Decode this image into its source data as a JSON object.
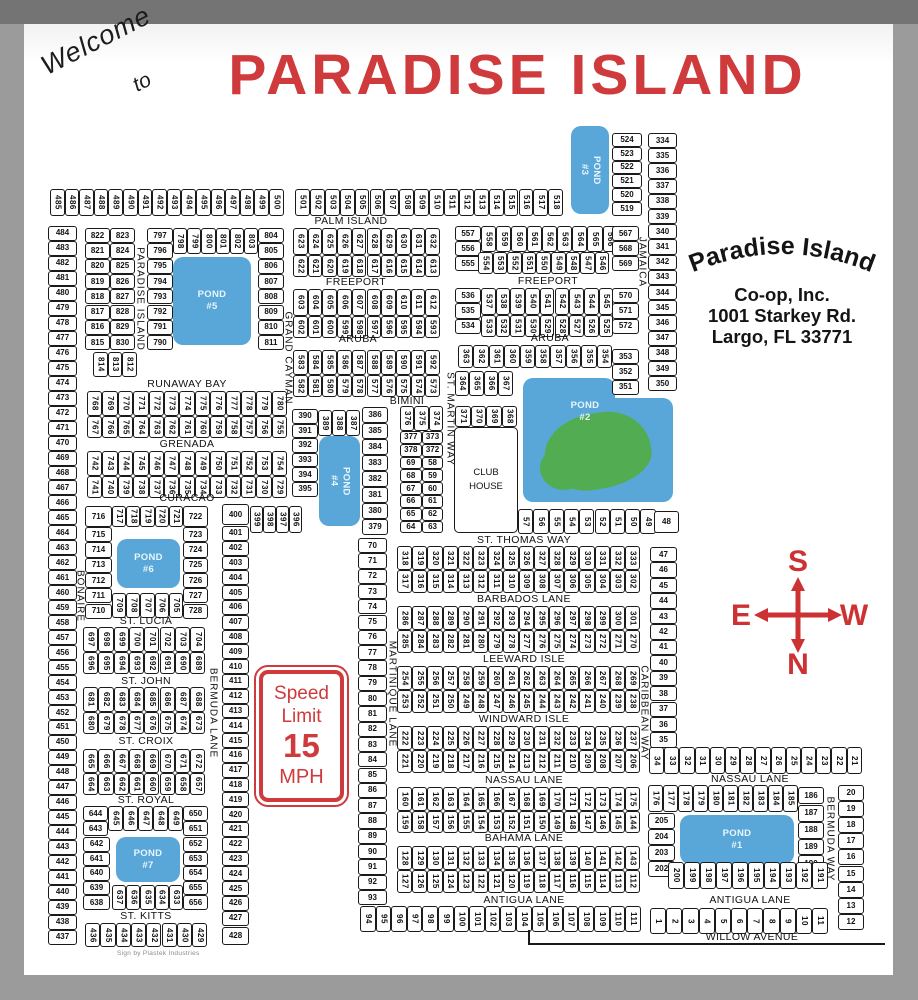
{
  "title": {
    "welcome": "Welcome",
    "to": "to",
    "main": "PARADISE ISLAND"
  },
  "address": {
    "line1": "Paradise Island",
    "line2": "Co-op, Inc.",
    "line3": "1001 Starkey Rd.",
    "line4": "Largo, FL   33771"
  },
  "speed_sign": {
    "l1": "Speed",
    "l2": "Limit",
    "l3": "15",
    "l4": "MPH"
  },
  "compass": {
    "top": "S",
    "left": "E",
    "right": "W",
    "bottom": "N"
  },
  "club_house": {
    "l1": "CLUB",
    "l2": "HOUSE"
  },
  "page": {
    "credit": "Sign by Plastek Industries"
  },
  "colors": {
    "red": "#cf3a3c",
    "pond": "#58a7d8",
    "green": "#52ad52",
    "ink": "#1a1a1a"
  },
  "map": {
    "streets": [
      {
        "label": "PALM ISLAND",
        "x": 351,
        "y": 221
      },
      {
        "label": "FREEPORT",
        "x": 356,
        "y": 282
      },
      {
        "label": "FREEPORT",
        "x": 548,
        "y": 281
      },
      {
        "label": "ARUBA",
        "x": 358,
        "y": 339
      },
      {
        "label": "ARUBA",
        "x": 550,
        "y": 338
      },
      {
        "label": "RUNAWAY BAY",
        "x": 187,
        "y": 384
      },
      {
        "label": "GRENADA",
        "x": 187,
        "y": 444
      },
      {
        "label": "CURACAO",
        "x": 187,
        "y": 498
      },
      {
        "label": "BIMINI",
        "x": 407,
        "y": 401
      },
      {
        "label": "ST. THOMAS WAY",
        "x": 524,
        "y": 540
      },
      {
        "label": "BARBADOS LANE",
        "x": 524,
        "y": 599
      },
      {
        "label": "LEEWARD ISLE",
        "x": 524,
        "y": 659
      },
      {
        "label": "WINDWARD ISLE",
        "x": 524,
        "y": 719
      },
      {
        "label": "NASSAU LANE",
        "x": 524,
        "y": 780
      },
      {
        "label": "NASSAU LANE",
        "x": 750,
        "y": 779
      },
      {
        "label": "BAHAMA LANE",
        "x": 524,
        "y": 838
      },
      {
        "label": "ANTIGUA LANE",
        "x": 524,
        "y": 900
      },
      {
        "label": "ANTIGUA LANE",
        "x": 750,
        "y": 900
      },
      {
        "label": "WILLOW AVENUE",
        "x": 752,
        "y": 937
      },
      {
        "label": "ST. LUCIA",
        "x": 146,
        "y": 621
      },
      {
        "label": "ST. JOHN",
        "x": 146,
        "y": 681
      },
      {
        "label": "ST. CROIX",
        "x": 146,
        "y": 741
      },
      {
        "label": "ST. ROYAL",
        "x": 146,
        "y": 800
      },
      {
        "label": "ST. KITTS",
        "x": 146,
        "y": 916
      },
      {
        "label": "PARADISE ISLAND",
        "x": 140,
        "y": 299,
        "v": true
      },
      {
        "label": "GRAND CAYMAN",
        "x": 288,
        "y": 358,
        "v": true
      },
      {
        "label": "BONAIRE",
        "x": 80,
        "y": 596,
        "v": true
      },
      {
        "label": "BERMUDA LANE",
        "x": 213,
        "y": 713,
        "v": true
      },
      {
        "label": "MARTINIQUE LANE",
        "x": 392,
        "y": 694,
        "v": true
      },
      {
        "label": "ST. MARTIN WAY",
        "x": 450,
        "y": 419,
        "v": true
      },
      {
        "label": "CARIBBEAN WAY",
        "x": 644,
        "y": 713,
        "v": true
      },
      {
        "label": "BERMUDA WAY",
        "x": 830,
        "y": 839,
        "v": true
      },
      {
        "label": "JAMAICA",
        "x": 642,
        "y": 262,
        "v": true
      }
    ],
    "ponds": [
      {
        "label": "POND",
        "num": "#5",
        "x": 173,
        "y": 257,
        "w": 78,
        "h": 88
      },
      {
        "label": "POND",
        "num": "#3",
        "x": 571,
        "y": 126,
        "w": 38,
        "h": 88,
        "v": true
      },
      {
        "label": "",
        "num": "",
        "x": 523,
        "y": 378,
        "w": 92,
        "h": 40
      },
      {
        "label": "",
        "num": "",
        "x": 523,
        "y": 398,
        "w": 150,
        "h": 104
      },
      {
        "label": "POND",
        "num": "#2",
        "x": 549,
        "y": 394,
        "w": 72,
        "h": 36,
        "bare": true
      },
      {
        "label": "POND",
        "num": "#4",
        "x": 319,
        "y": 436,
        "w": 41,
        "h": 90,
        "v": true
      },
      {
        "label": "POND",
        "num": "#6",
        "x": 117,
        "y": 539,
        "w": 63,
        "h": 49
      },
      {
        "label": "POND",
        "num": "#7",
        "x": 116,
        "y": 837,
        "w": 64,
        "h": 45
      },
      {
        "label": "POND",
        "num": "#1",
        "x": 680,
        "y": 815,
        "w": 114,
        "h": 49
      }
    ],
    "strips": [
      {
        "x": 50,
        "y": 189,
        "d": "h",
        "w": 14.6,
        "h": 27,
        "r": 1,
        "n": [
          "485-500"
        ]
      },
      {
        "x": 295,
        "y": 189,
        "d": "h",
        "w": 14.9,
        "h": 27,
        "r": 1,
        "n": [
          "501-518"
        ]
      },
      {
        "x": 612,
        "y": 133,
        "d": "v",
        "w": 30,
        "h": 13.8,
        "n": [
          "524-519"
        ]
      },
      {
        "x": 648,
        "y": 133,
        "d": "v",
        "w": 29,
        "h": 15.2,
        "n": [
          "334-350"
        ]
      },
      {
        "x": 48,
        "y": 226,
        "d": "v",
        "w": 29,
        "h": 14.97,
        "n": [
          "484-437"
        ]
      },
      {
        "x": 85,
        "y": 228,
        "d": "v",
        "w": 25,
        "h": 15.3,
        "n": [
          "822-815"
        ]
      },
      {
        "x": 110,
        "y": 228,
        "d": "v",
        "w": 25,
        "h": 15.3,
        "n": [
          "823-830"
        ]
      },
      {
        "x": 93,
        "y": 352,
        "d": "h",
        "w": 14.5,
        "h": 25,
        "r": 1,
        "n": [
          "814-812"
        ]
      },
      {
        "x": 147,
        "y": 228,
        "d": "v",
        "w": 26,
        "h": 15.3,
        "n": [
          "797-790"
        ]
      },
      {
        "x": 173,
        "y": 228,
        "d": "h",
        "w": 14.2,
        "h": 26,
        "r": 1,
        "n": [
          "798-803"
        ]
      },
      {
        "x": 258,
        "y": 228,
        "d": "v",
        "w": 26,
        "h": 15.3,
        "n": [
          "804-811"
        ]
      },
      {
        "x": 293,
        "y": 228,
        "d": "h",
        "w": 14.7,
        "h": 27,
        "r": 1,
        "n": [
          "623-632"
        ]
      },
      {
        "x": 293,
        "y": 255,
        "d": "h",
        "w": 14.7,
        "h": 22,
        "r": 1,
        "n": [
          "622-613"
        ]
      },
      {
        "x": 293,
        "y": 289,
        "d": "h",
        "w": 14.7,
        "h": 27,
        "r": 1,
        "n": [
          "603-612"
        ]
      },
      {
        "x": 293,
        "y": 316,
        "d": "h",
        "w": 14.7,
        "h": 22,
        "r": 1,
        "n": [
          "602-593"
        ]
      },
      {
        "x": 293,
        "y": 350,
        "d": "h",
        "w": 14.7,
        "h": 25,
        "r": 1,
        "n": [
          "583-592"
        ]
      },
      {
        "x": 293,
        "y": 375,
        "d": "h",
        "w": 14.7,
        "h": 22,
        "r": 1,
        "n": [
          "582-573"
        ]
      },
      {
        "x": 87,
        "y": 391,
        "d": "h",
        "w": 15.4,
        "h": 25,
        "r": 1,
        "n": [
          "768-780"
        ]
      },
      {
        "x": 87,
        "y": 416,
        "d": "h",
        "w": 15.4,
        "h": 22,
        "r": 1,
        "n": [
          "767-755"
        ]
      },
      {
        "x": 87,
        "y": 451,
        "d": "h",
        "w": 15.4,
        "h": 25,
        "r": 1,
        "n": [
          "742-754"
        ]
      },
      {
        "x": 87,
        "y": 476,
        "d": "h",
        "w": 15.4,
        "h": 22,
        "r": 1,
        "n": [
          "741-729"
        ]
      },
      {
        "x": 85,
        "y": 506,
        "d": "v",
        "w": 27,
        "h": 21,
        "n": [
          716
        ]
      },
      {
        "x": 112,
        "y": 506,
        "d": "h",
        "w": 14.2,
        "h": 21,
        "r": 1,
        "n": [
          "717-721"
        ]
      },
      {
        "x": 183,
        "y": 506,
        "d": "v",
        "w": 25,
        "h": 21,
        "n": [
          722
        ]
      },
      {
        "x": 292,
        "y": 409,
        "d": "v",
        "w": 26,
        "h": 14.6,
        "n": [
          "390-395"
        ]
      },
      {
        "x": 318,
        "y": 410,
        "d": "h",
        "w": 14,
        "h": 26,
        "r": 1,
        "n": [
          "389-387"
        ]
      },
      {
        "x": 362,
        "y": 407,
        "d": "v",
        "w": 26,
        "h": 16,
        "n": [
          "386-379"
        ]
      },
      {
        "x": 222,
        "y": 504,
        "d": "v",
        "w": 27,
        "h": 21,
        "n": [
          400
        ]
      },
      {
        "x": 250,
        "y": 506,
        "d": "h",
        "w": 13,
        "h": 27,
        "r": 1,
        "n": [
          "399-396"
        ]
      },
      {
        "x": 222,
        "y": 526,
        "d": "v",
        "w": 27,
        "h": 14.8,
        "n": [
          "401-427"
        ]
      },
      {
        "x": 222,
        "y": 927,
        "d": "v",
        "w": 27,
        "h": 18,
        "n": [
          428
        ]
      },
      {
        "x": 400,
        "y": 406,
        "d": "h",
        "w": 14.4,
        "h": 25,
        "r": 1,
        "n": [
          "376-374"
        ]
      },
      {
        "x": 400,
        "y": 431,
        "d": "v",
        "w": 21.7,
        "h": 12.8,
        "n": [
          377,
          378,
          69,
          68,
          67,
          66,
          65,
          64
        ]
      },
      {
        "x": 421.7,
        "y": 431,
        "d": "v",
        "w": 21.7,
        "h": 12.8,
        "n": [
          373,
          372,
          58,
          59,
          60,
          61,
          62,
          63
        ]
      },
      {
        "x": 455,
        "y": 371,
        "d": "h",
        "w": 14.4,
        "h": 25,
        "r": 1,
        "n": [
          "364-367"
        ]
      },
      {
        "x": 455,
        "y": 406,
        "d": "h",
        "w": 15.5,
        "h": 21,
        "r": 1,
        "n": [
          "371-368"
        ]
      },
      {
        "x": 458,
        "y": 345,
        "d": "h",
        "w": 15.4,
        "h": 23,
        "r": 1,
        "n": [
          "363-354"
        ]
      },
      {
        "x": 612,
        "y": 349,
        "d": "v",
        "w": 27,
        "h": 15.3,
        "n": [
          "353-351"
        ]
      },
      {
        "x": 455,
        "y": 226,
        "d": "v",
        "w": 26,
        "h": 15,
        "n": [
          "557-555"
        ]
      },
      {
        "x": 481,
        "y": 226,
        "d": "h",
        "w": 15.2,
        "h": 26,
        "r": 1,
        "n": [
          "558-566"
        ]
      },
      {
        "x": 612,
        "y": 226,
        "d": "v",
        "w": 27,
        "h": 15,
        "n": [
          "567-569"
        ]
      },
      {
        "x": 478,
        "y": 252,
        "d": "h",
        "w": 14.6,
        "h": 22,
        "r": 1,
        "n": [
          "554-546"
        ]
      },
      {
        "x": 455,
        "y": 288,
        "d": "v",
        "w": 26,
        "h": 15.3,
        "n": [
          "536-534"
        ]
      },
      {
        "x": 481,
        "y": 288,
        "d": "h",
        "w": 14.7,
        "h": 27,
        "r": 1,
        "n": [
          "537-545"
        ]
      },
      {
        "x": 612,
        "y": 288,
        "d": "v",
        "w": 27,
        "h": 15.3,
        "n": [
          "570-572"
        ]
      },
      {
        "x": 481,
        "y": 315,
        "d": "h",
        "w": 14.7,
        "h": 22,
        "r": 1,
        "n": [
          "533-525"
        ]
      },
      {
        "x": 518,
        "y": 509,
        "d": "h",
        "w": 15.3,
        "h": 25,
        "r": 1,
        "n": [
          "57-49"
        ]
      },
      {
        "x": 654,
        "y": 511,
        "d": "v",
        "w": 25,
        "h": 22,
        "n": [
          48
        ]
      },
      {
        "x": 650,
        "y": 547,
        "d": "v",
        "w": 27,
        "h": 15.45,
        "n": [
          "47-35"
        ]
      },
      {
        "x": 649,
        "y": 747,
        "d": "h",
        "w": 15.2,
        "h": 27,
        "r": 1,
        "n": [
          "34-21"
        ]
      },
      {
        "x": 838,
        "y": 785,
        "d": "v",
        "w": 26,
        "h": 16.1,
        "n": [
          "20-12"
        ]
      },
      {
        "x": 650,
        "y": 908,
        "d": "h",
        "w": 16.2,
        "h": 26,
        "r": 1,
        "n": [
          "1-11"
        ]
      },
      {
        "x": 397,
        "y": 546,
        "d": "h",
        "w": 15.2,
        "h": 24,
        "r": 1,
        "n": [
          "318-333"
        ]
      },
      {
        "x": 397,
        "y": 570,
        "d": "h",
        "w": 15.2,
        "h": 23,
        "r": 1,
        "n": [
          "317-302"
        ]
      },
      {
        "x": 397,
        "y": 606,
        "d": "h",
        "w": 15.2,
        "h": 24,
        "r": 1,
        "n": [
          "286-301"
        ]
      },
      {
        "x": 397,
        "y": 630,
        "d": "h",
        "w": 15.2,
        "h": 23,
        "r": 1,
        "n": [
          "285-270"
        ]
      },
      {
        "x": 397,
        "y": 666,
        "d": "h",
        "w": 15.2,
        "h": 24,
        "r": 1,
        "n": [
          "254-269"
        ]
      },
      {
        "x": 397,
        "y": 690,
        "d": "h",
        "w": 15.2,
        "h": 23,
        "r": 1,
        "n": [
          "253-238"
        ]
      },
      {
        "x": 397,
        "y": 726,
        "d": "h",
        "w": 15.2,
        "h": 24,
        "r": 1,
        "n": [
          "222-237"
        ]
      },
      {
        "x": 397,
        "y": 750,
        "d": "h",
        "w": 15.2,
        "h": 23,
        "r": 1,
        "n": [
          "221-206"
        ]
      },
      {
        "x": 397,
        "y": 787,
        "d": "h",
        "w": 15.2,
        "h": 24,
        "r": 1,
        "n": [
          "160-175"
        ]
      },
      {
        "x": 397,
        "y": 811,
        "d": "h",
        "w": 15.2,
        "h": 22,
        "r": 1,
        "n": [
          "159-144"
        ]
      },
      {
        "x": 397,
        "y": 846,
        "d": "h",
        "w": 15.2,
        "h": 24,
        "r": 1,
        "n": [
          "128-143"
        ]
      },
      {
        "x": 397,
        "y": 870,
        "d": "h",
        "w": 15.2,
        "h": 23,
        "r": 1,
        "n": [
          "127-112"
        ]
      },
      {
        "x": 358,
        "y": 538,
        "d": "v",
        "w": 29,
        "h": 15.3,
        "n": [
          "70-93"
        ]
      },
      {
        "x": 360,
        "y": 906,
        "d": "h",
        "w": 15.6,
        "h": 26,
        "r": 1,
        "n": [
          "94-111"
        ]
      },
      {
        "x": 85,
        "y": 527,
        "d": "v",
        "w": 27,
        "h": 15.3,
        "n": [
          "715-710"
        ]
      },
      {
        "x": 183,
        "y": 527,
        "d": "v",
        "w": 25,
        "h": 15.3,
        "n": [
          "723-728"
        ]
      },
      {
        "x": 112,
        "y": 593,
        "d": "h",
        "w": 14.2,
        "h": 25,
        "r": 1,
        "n": [
          "709-705"
        ]
      },
      {
        "x": 83,
        "y": 627,
        "d": "h",
        "w": 15.3,
        "h": 25,
        "r": 1,
        "n": [
          "697-704"
        ]
      },
      {
        "x": 83,
        "y": 652,
        "d": "h",
        "w": 15.3,
        "h": 22,
        "r": 1,
        "n": [
          "696-689"
        ]
      },
      {
        "x": 83,
        "y": 687,
        "d": "h",
        "w": 15.3,
        "h": 25,
        "r": 1,
        "n": [
          "681-688"
        ]
      },
      {
        "x": 83,
        "y": 712,
        "d": "h",
        "w": 15.3,
        "h": 22,
        "r": 1,
        "n": [
          "680-673"
        ]
      },
      {
        "x": 83,
        "y": 749,
        "d": "h",
        "w": 15.3,
        "h": 24,
        "r": 1,
        "n": [
          "665-672"
        ]
      },
      {
        "x": 83,
        "y": 773,
        "d": "h",
        "w": 15.3,
        "h": 22,
        "r": 1,
        "n": [
          "664-657"
        ]
      },
      {
        "x": 83,
        "y": 806,
        "d": "v",
        "w": 25,
        "h": 15,
        "n": [
          644,
          643
        ]
      },
      {
        "x": 108,
        "y": 806,
        "d": "h",
        "w": 15,
        "h": 25,
        "r": 1,
        "n": [
          "645-649"
        ]
      },
      {
        "x": 183,
        "y": 806,
        "d": "v",
        "w": 25,
        "h": 15,
        "n": [
          650,
          651
        ]
      },
      {
        "x": 83,
        "y": 837,
        "d": "v",
        "w": 27,
        "h": 14.6,
        "n": [
          "642-638"
        ]
      },
      {
        "x": 183,
        "y": 837,
        "d": "v",
        "w": 25,
        "h": 14.6,
        "n": [
          "652-656"
        ]
      },
      {
        "x": 112,
        "y": 885,
        "d": "h",
        "w": 14.2,
        "h": 25,
        "r": 1,
        "n": [
          "637-633"
        ]
      },
      {
        "x": 85,
        "y": 923,
        "d": "h",
        "w": 15.3,
        "h": 24,
        "r": 1,
        "n": [
          "436-429"
        ]
      },
      {
        "x": 648,
        "y": 785,
        "d": "h",
        "w": 15,
        "h": 27,
        "r": 1,
        "n": [
          "176-185"
        ]
      },
      {
        "x": 798,
        "y": 787,
        "d": "v",
        "w": 26,
        "h": 17,
        "n": [
          186
        ]
      },
      {
        "x": 798,
        "y": 805,
        "d": "v",
        "w": 26,
        "h": 16.8,
        "n": [
          "187-190"
        ]
      },
      {
        "x": 648,
        "y": 813,
        "d": "v",
        "w": 27,
        "h": 16,
        "n": [
          "205-202"
        ]
      },
      {
        "x": 668,
        "y": 862,
        "d": "h",
        "w": 16,
        "h": 27,
        "r": 1,
        "n": [
          "200-191"
        ]
      }
    ],
    "lines": [
      {
        "x": 528,
        "y": 943,
        "w": 357,
        "h": 2
      },
      {
        "x": 528,
        "y": 930,
        "w": 2,
        "h": 15
      }
    ]
  }
}
